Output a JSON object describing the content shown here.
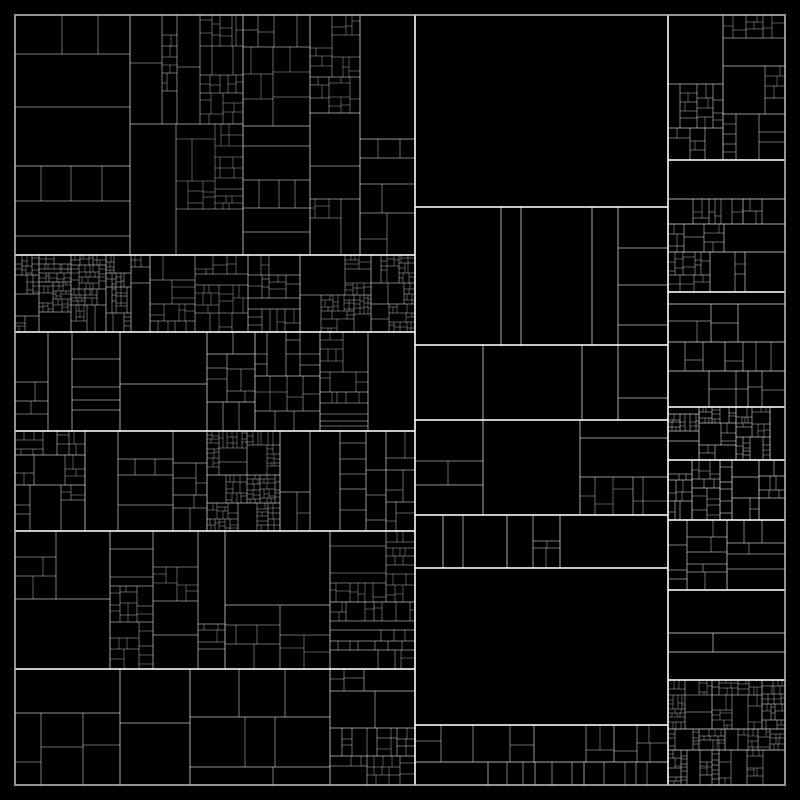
{
  "artwork": {
    "canvas": {
      "width": 800,
      "height": 800
    },
    "colors": {
      "background": "#000000",
      "line": "#ffffff",
      "frame": "#b8b8b8"
    },
    "frame": {
      "x": 15,
      "y": 15,
      "width": 770,
      "height": 770,
      "stroke_width": 2,
      "opacity": 0.8
    },
    "style": {
      "widths": [
        2,
        2,
        1,
        1,
        1,
        1,
        1,
        1
      ],
      "opacities": [
        0.8,
        0.78,
        0.66,
        0.56,
        0.48,
        0.41,
        0.36,
        0.32
      ]
    },
    "generator": {
      "seed": 73,
      "stop_growth": 0.05,
      "max_depth": 10,
      "classes": {
        "xs": {
          "min": 46,
          "stop": 0.5
        },
        "s": {
          "min": 28,
          "stop": 0.36
        },
        "m": {
          "min": 14,
          "stop": 0.22
        },
        "d": {
          "min": 7.5,
          "stop": 0.12
        },
        "xd": {
          "min": 4,
          "stop": 0.06
        }
      }
    },
    "tree": {
      "dir": "v",
      "cuts": [
        415,
        668
      ],
      "children": [
        {
          "dir": "h",
          "cuts": [
            255,
            332,
            431,
            531,
            669
          ],
          "children": [
            {
              "dir": "v",
              "cuts": [
                130,
                243,
                310,
                360
              ],
              "children": [
                {
                  "leaf": "s"
                },
                {
                  "leaf": "d"
                },
                {
                  "leaf": "m"
                },
                {
                  "leaf": "d"
                },
                {
                  "leaf": "m"
                }
              ]
            },
            {
              "dir": "v",
              "cuts": [
                150,
                300
              ],
              "children": [
                {
                  "leaf": "xd"
                },
                {
                  "leaf": "d"
                },
                {
                  "leaf": "xd"
                }
              ]
            },
            {
              "dir": "v",
              "cuts": [
                120,
                207,
                255,
                320
              ],
              "children": [
                {
                  "leaf": "m"
                },
                {
                  "leaf": "xs"
                },
                {
                  "leaf": "m"
                },
                {
                  "leaf": "m"
                },
                {
                  "leaf": "d"
                }
              ]
            },
            {
              "dir": "v",
              "cuts": [
                85,
                207,
                280
              ],
              "children": [
                {
                  "leaf": "d"
                },
                {
                  "leaf": "m"
                },
                {
                  "leaf": "xd"
                },
                {
                  "leaf": "m"
                }
              ]
            },
            {
              "dir": "v",
              "cuts": [
                110,
                225,
                330
              ],
              "children": [
                {
                  "leaf": "m"
                },
                {
                  "leaf": "d"
                },
                {
                  "leaf": "m"
                },
                {
                  "leaf": "d"
                }
              ]
            },
            {
              "dir": "v",
              "cuts": [
                120,
                190,
                330
              ],
              "children": [
                {
                  "leaf": "s"
                },
                {
                  "leaf": "xs"
                },
                {
                  "leaf": "s"
                },
                {
                  "leaf": "d"
                }
              ]
            }
          ]
        },
        {
          "dir": "h",
          "cuts": [
            207,
            345,
            420,
            515,
            568,
            725
          ],
          "children": [
            {
              "leaf": "e"
            },
            {
              "dir": "v",
              "cuts": [
                501,
                521,
                592,
                618
              ],
              "children": [
                {
                  "leaf": "e"
                },
                {
                  "leaf": "e"
                },
                {
                  "leaf": "e"
                },
                {
                  "leaf": "e"
                },
                {
                  "leaf": "s"
                }
              ]
            },
            {
              "dir": "v",
              "cuts": [
                483,
                582,
                618
              ],
              "children": [
                {
                  "leaf": "e"
                },
                {
                  "leaf": "e"
                },
                {
                  "leaf": "e"
                },
                {
                  "leaf": "s"
                }
              ]
            },
            {
              "dir": "v",
              "cuts": [
                483,
                580
              ],
              "children": [
                {
                  "leaf": "s"
                },
                {
                  "leaf": "e"
                },
                {
                  "leaf": "m"
                }
              ]
            },
            {
              "dir": "v",
              "cuts": [
                443,
                507,
                560
              ],
              "children": [
                {
                  "leaf": "s"
                },
                {
                  "leaf": "s"
                },
                {
                  "leaf": "d"
                },
                {
                  "leaf": "e"
                }
              ]
            },
            {
              "leaf": "e"
            },
            {
              "dir": "h",
              "cuts": [
                762
              ],
              "children": [
                {
                  "leaf": "m"
                },
                {
                  "leaf": "m"
                }
              ]
            }
          ]
        },
        {
          "dir": "h",
          "cuts": [
            160,
            292,
            407,
            460,
            520,
            590,
            680
          ],
          "children": [
            {
              "leaf": "d"
            },
            {
              "leaf": "d"
            },
            {
              "leaf": "m"
            },
            {
              "leaf": "xd"
            },
            {
              "leaf": "d"
            },
            {
              "leaf": "m"
            },
            {
              "leaf": "m"
            },
            {
              "leaf": "xd"
            }
          ]
        }
      ]
    }
  }
}
